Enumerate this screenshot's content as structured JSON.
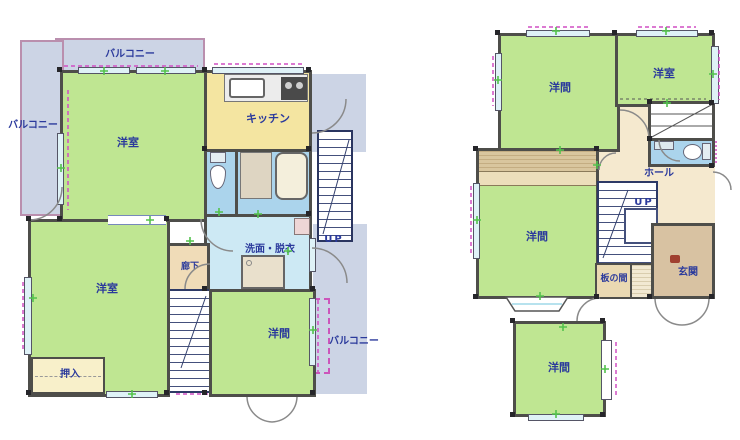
{
  "plan_left": {
    "balcony_top": "バルコニー",
    "balcony_left": "バルコニー",
    "balcony_right": "バルコニー",
    "room_nw": "洋室",
    "kitchen": "キッチン",
    "washroom": "洗面・脱衣",
    "corridor": "廊下",
    "room_sw": "洋室",
    "closet": "押入",
    "room_se": "洋間",
    "stairs_up": "UP"
  },
  "plan_right": {
    "room_nw": "洋間",
    "room_ne": "洋室",
    "hall": "ホール",
    "stairs_up": "UP",
    "room_w": "洋間",
    "itanoma": "板の間",
    "entrance": "玄関",
    "room_s": "洋間"
  },
  "colors": {
    "room_green": "#bfe692",
    "kitchen_yellow": "#f4e5a1",
    "bath_blue": "#abd4ec",
    "washroom_blue": "#cde9f4",
    "hall_tan": "#f5e9cf",
    "entrance_tan": "#d8c2a2",
    "closet_cream": "#f8f0ca",
    "balcony_gray": "#ccd4e5",
    "wall_dark": "#4e4e4a",
    "text_navy": "#2b3a9c",
    "rail_pink": "#d14fc4",
    "vent_green": "#53c24c"
  }
}
